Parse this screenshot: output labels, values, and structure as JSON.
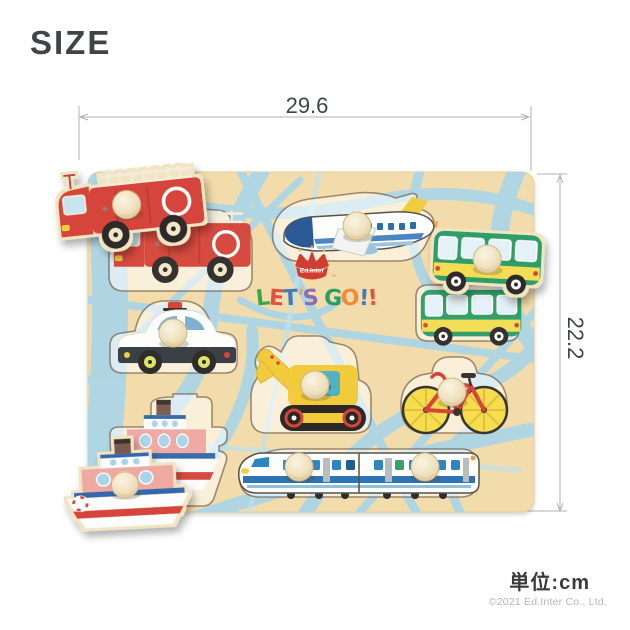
{
  "page": {
    "title": "SIZE",
    "unit_label": "単位:cm",
    "copyright": "©2021 Ed.Inter Co., Ltd."
  },
  "dimensions": {
    "width_cm": "29.6",
    "height_cm": "22.2"
  },
  "board": {
    "logo": "Ed.Inter",
    "logo_tm": "™",
    "slogan": "LET'S GO!!",
    "slogan_letters": [
      {
        "ch": "L",
        "color": "#3fa44d",
        "rot": -6
      },
      {
        "ch": "E",
        "color": "#e0523f",
        "rot": 4
      },
      {
        "ch": "T",
        "color": "#4379bd",
        "rot": -3
      },
      {
        "ch": "'",
        "color": "#efa23a",
        "rot": 5
      },
      {
        "ch": "S",
        "color": "#8e6cb0",
        "rot": -5
      },
      {
        "ch": " ",
        "color": "#000000",
        "rot": 0
      },
      {
        "ch": "G",
        "color": "#2b9e5d",
        "rot": 4
      },
      {
        "ch": "O",
        "color": "#ef8c3a",
        "rot": -5
      },
      {
        "ch": "!",
        "color": "#4379bd",
        "rot": 3
      },
      {
        "ch": "!",
        "color": "#e0523f",
        "rot": -4
      }
    ],
    "pieces": [
      "fire-truck",
      "airplane",
      "bus",
      "police-car",
      "excavator",
      "bicycle",
      "ship",
      "bullet-train"
    ]
  },
  "colors": {
    "board_wood": "#f3dcab",
    "road_blue": "#a9d5e9",
    "dimension_gray": "#b0b0b0",
    "text_dark": "#3f4447",
    "red": "#d6453a",
    "yellow": "#f2cb3d",
    "green": "#2d9e68",
    "blue": "#2e74b5",
    "knob_wood": "#f3ead2"
  }
}
